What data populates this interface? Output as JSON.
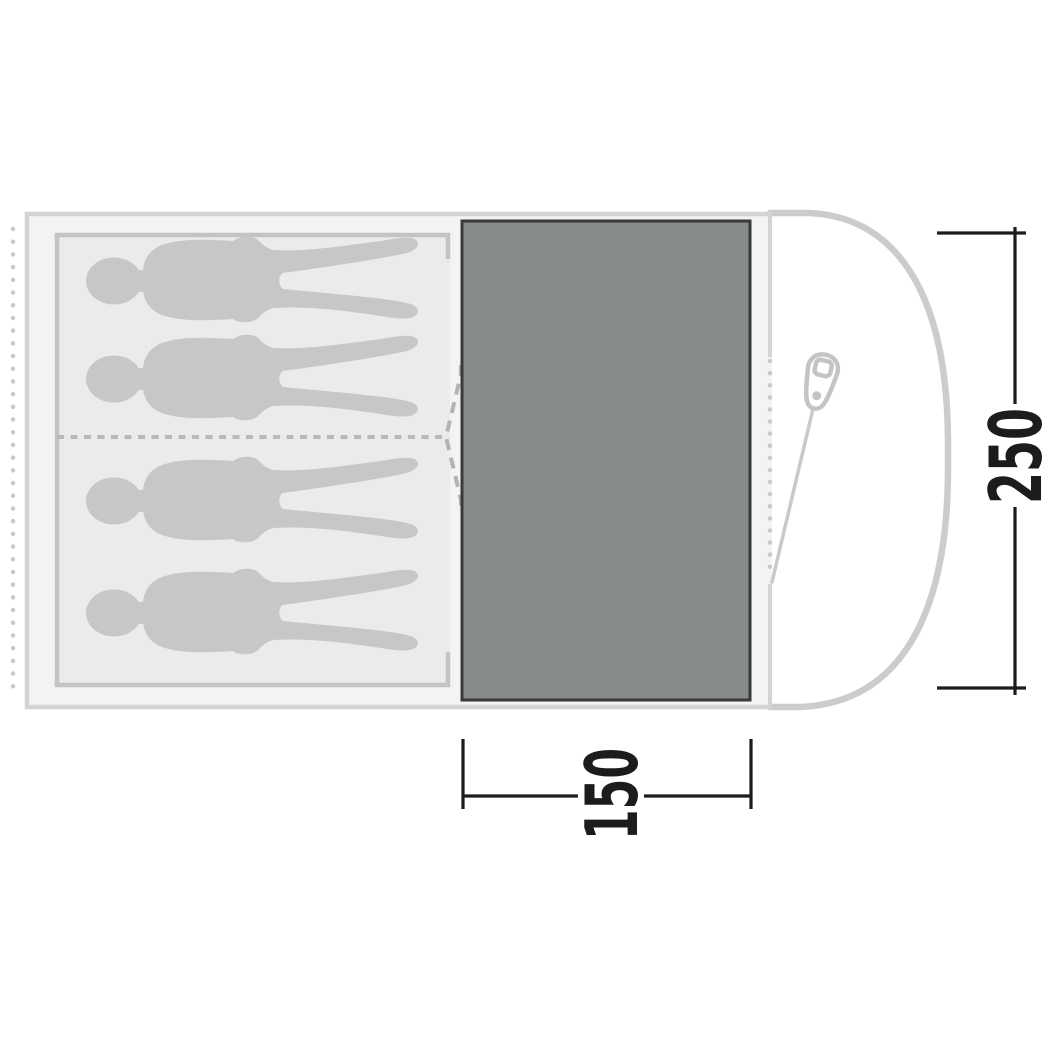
{
  "diagram": {
    "type": "tent-floorplan-top-view",
    "sleeping_area": {
      "person_silhouettes": 4,
      "compartments": 2
    },
    "dimensions": {
      "depth": {
        "label": "250"
      },
      "living_area_width": {
        "label": "150"
      }
    },
    "colors": {
      "background": "#ffffff",
      "tent_outline": "#d4d4d4",
      "porch_outline": "#cccccc",
      "floor_fill": "#f3f3f3",
      "sleeping_area_fill": "#ebebeb",
      "sleeping_area_border": "#c3c3c3",
      "person_silhouette": "#c6c8c7",
      "living_panel_fill": "#888c89",
      "living_panel_border": "#3a3a3a",
      "dashed_lines": "#b5b5b5",
      "dots": "#c9c9c9",
      "zipper_pull": "#c4c4c4",
      "dimension_lines": "#1c1c1c"
    }
  }
}
